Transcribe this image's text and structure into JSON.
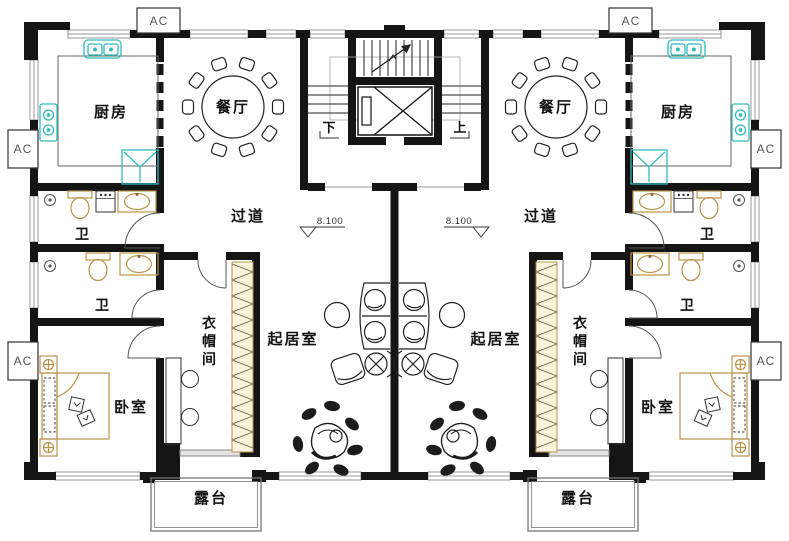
{
  "plan": {
    "rooms": {
      "kitchen": "厨房",
      "dining": "餐厅",
      "corridor": "过道",
      "bathroom": "卫",
      "cloakroom_chars": [
        "衣",
        "帽",
        "间"
      ],
      "living_room": "起居室",
      "bedroom": "卧室",
      "terrace": "露台"
    },
    "stairs": {
      "down": "下",
      "up": "上"
    },
    "elevation_marker": "8.100",
    "ac_unit": "AC",
    "colors": {
      "wall": "#151515",
      "window_line": "#999999",
      "fixture_cyan": "#2fbdbd",
      "furniture_tan": "#b9944a",
      "plant_dark": "#1c1c1c",
      "text": "#111111"
    }
  }
}
